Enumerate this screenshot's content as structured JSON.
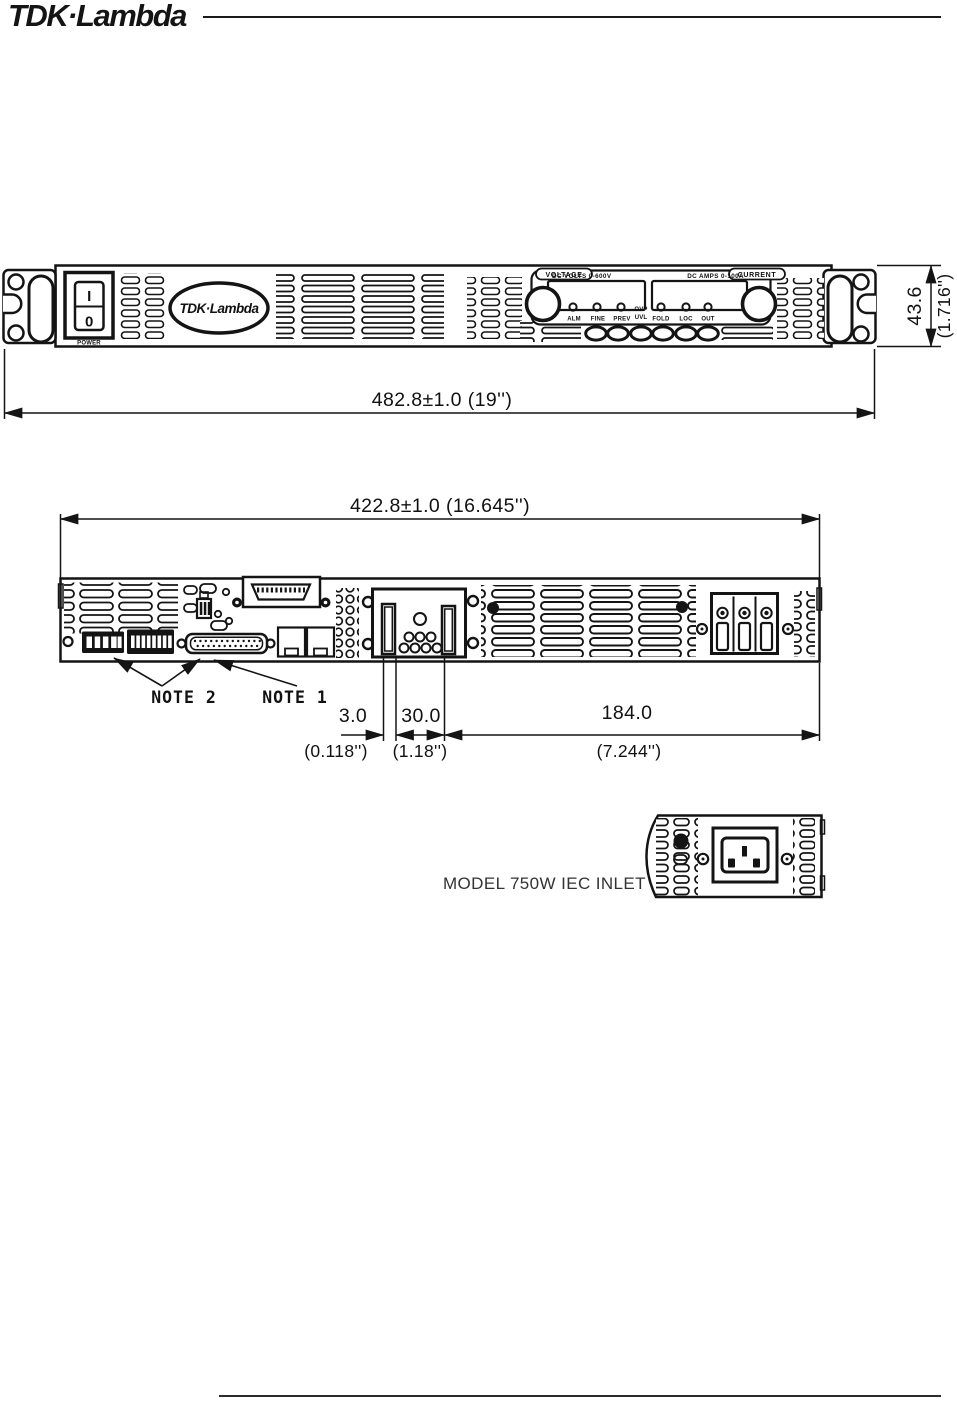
{
  "header": {
    "brand": "TDK·Lambda"
  },
  "front_view": {
    "power_switch": {
      "on": "I",
      "off": "0",
      "caption": "POWER"
    },
    "panel_logo": "TDK·Lambda",
    "voltage_section": "VOLTAGE",
    "current_section": "CURRENT",
    "volts_meter_label": "DC VOLTS   0-600V",
    "amps_meter_label": "DC AMPS   0-100A",
    "leds": {
      "alm": "ALM",
      "fine": "FINE",
      "prev": "PREV",
      "ovp": "OVP",
      "uvl": "UVL",
      "fold": "FOLD",
      "loc": "LOC",
      "out": "OUT"
    },
    "width_dim": "482.8±1.0  (19'')",
    "height_dim_mm": "43.6",
    "height_dim_in": "(1.716'')"
  },
  "rear_view": {
    "width_dim": "422.8±1.0  (16.645'')",
    "note2": "NOTE 2",
    "note1": "NOTE 1",
    "dim1_mm": "3.0",
    "dim1_in": "(0.118'')",
    "dim2_mm": "30.0",
    "dim2_in": "(1.18'')",
    "dim3_mm": "184.0",
    "dim3_in": "(7.244'')"
  },
  "inlet_detail": {
    "caption": "MODEL 750W IEC INLET"
  }
}
